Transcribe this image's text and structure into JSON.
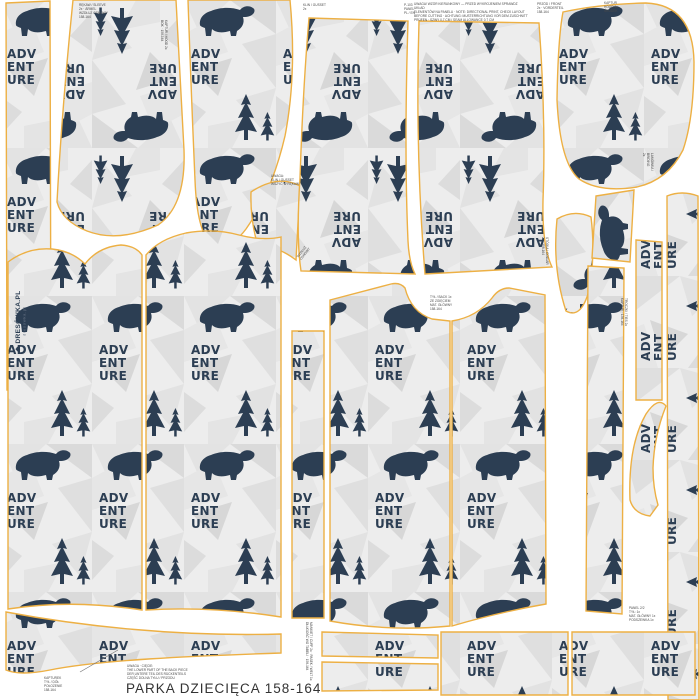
{
  "panel": {
    "title": "PARKA DZIECIĘCA 158-164"
  },
  "brand": {
    "icon": "❖",
    "name": "DRESÓWKA.PL",
    "sub": "dresowka.pl"
  },
  "pattern": {
    "lines": [
      "ADV",
      "ENT",
      "URE"
    ],
    "navy": "#2c3e53",
    "bg": "#ededed",
    "outline": "#edb044",
    "facets": [
      [
        "0,0 46,0 14,30",
        "#e3e3e3"
      ],
      [
        "46,0 92,0 92,34",
        "#dadada"
      ],
      [
        "0,34 30,18 44,52 0,66",
        "#e6e6e6"
      ],
      [
        "92,34 58,44 92,88",
        "#dfdfdf"
      ],
      [
        "8,70 48,58 34,96",
        "#d7d7d7"
      ],
      [
        "52,100 92,88 80,132",
        "#e2e2e2"
      ],
      [
        "0,96 22,112 0,136",
        "#dcdcdc"
      ],
      [
        "24,126 64,118 48,148 24,148",
        "#e4e4e4"
      ]
    ]
  },
  "pieces": [
    {
      "name": "strip-left",
      "orient": "up",
      "d": "M6,3 L50,1 L51,388 L7,390 Z"
    },
    {
      "name": "sleeve-top-left",
      "orient": "down",
      "d": "M73,0 L176,0 L184,150 Q186,206 158,225 Q118,243 87,231 Q62,221 57,202 Q62,108 73,0 Z"
    },
    {
      "name": "hood-side-left",
      "orient": "up",
      "d": "M188,0 L290,0 Q297,74 285,136 Q272,192 246,229 Q228,253 211,243 Q197,232 195,180 Q191,88 188,0 Z"
    },
    {
      "name": "gusset",
      "orient": "down",
      "d": "M251,192 Q278,174 300,186 L296,260 Q272,242 260,252 Q250,224 251,192 Z"
    },
    {
      "name": "sleeve-top-center-left",
      "orient": "down",
      "d": "M309,18 L408,21 Q404,150 408,241 Q409,262 415,274 L301,271 Q296,238 300,178 Q303,88 309,18 Z"
    },
    {
      "name": "sleeve-top-center-right",
      "orient": "down",
      "d": "M419,21 L539,23 Q546,120 543,200 Q542,246 552,267 L425,274 Q415,150 419,21 Z"
    },
    {
      "name": "hood-right",
      "orient": "up",
      "d": "M563,12 Q600,4 646,3 Q693,5 694,62 Q694,118 683,150 Q668,180 637,187 Q600,193 579,179 Q560,163 557,100 Q558,38 563,12 Z"
    },
    {
      "name": "collar-tail",
      "orient": "down",
      "d": "M557,219 Q574,209 591,217 Q596,258 588,294 Q580,319 566,311 Q552,268 557,219 Z"
    },
    {
      "name": "strip-right-top",
      "orient": "side",
      "d": "M596,196 L634,190 L630,262 L592,258 Z"
    },
    {
      "name": "strip-front-edge",
      "orient": "up",
      "d": "M588,266 L624,268 L622,614 L586,611 Z"
    },
    {
      "name": "strip-binding-trees",
      "orient": "side",
      "d": "M636,240 L662,242 L662,400 L636,400 Z"
    },
    {
      "name": "strip-right-edge",
      "orient": "side",
      "d": "M667,196 Q682,190 698,196 L699,700 L668,700 Z"
    },
    {
      "name": "collar-curve",
      "orient": "side",
      "d": "M630,500 Q628,445 646,414 Q658,396 666,406 Q654,436 653,468 Q653,488 658,505 L650,516 Q634,514 630,500 Z"
    },
    {
      "name": "body-left-a",
      "orient": "up",
      "d": "M8,262 Q28,247 52,249 Q72,251 85,264 Q98,247 121,245 Q136,246 142,255 L142,610 Q72,599 8,609 Z"
    },
    {
      "name": "body-left-b",
      "orient": "up",
      "d": "M146,255 Q159,239 186,233 Q214,228 239,235 Q262,241 281,237 L281,617 Q212,606 146,610 Z"
    },
    {
      "name": "hem-band",
      "orient": "up",
      "d": "M6,612 C80,626 180,637 281,634 L281,653 C190,656 100,660 50,670 Q20,676 6,670 Z"
    },
    {
      "name": "strip-center",
      "orient": "up",
      "d": "M292,331 L324,331 L324,618 L292,618 Z"
    },
    {
      "name": "body-center-left",
      "orient": "up",
      "d": "M330,300 L391,284 Q400,282 405,288 Q411,312 432,319 L450,321 L450,626 Q390,632 330,621 Z"
    },
    {
      "name": "body-center-right",
      "orient": "up",
      "d": "M452,321 Q477,317 492,298 Q499,288 509,288 L545,295 L546,604 Q500,612 452,626 Z"
    },
    {
      "name": "cuff-top",
      "orient": "up",
      "d": "M322,632 L438,635 L438,658 L322,656 Z"
    },
    {
      "name": "cuff-bottom",
      "orient": "up",
      "d": "M322,662 L438,664 L438,690 L322,691 Z"
    },
    {
      "name": "pocket-left",
      "orient": "up",
      "d": "M441,632 L568,632 L568,695 L441,695 Z"
    },
    {
      "name": "pocket-right",
      "orient": "up",
      "d": "M572,632 L695,632 L695,695 L572,695 Z"
    }
  ],
  "labels": [
    {
      "name": "sleeve-label",
      "x": 79,
      "y": 3,
      "rot": 0,
      "size": 3.2,
      "lines": [
        "RĘKAW / SLEEVE",
        "2x · ÄRMEL",
        "WZDŁUŻ OSNOWY",
        "158-164"
      ]
    },
    {
      "name": "hood-side-label",
      "x": 168,
      "y": 20,
      "rot": 90,
      "size": 3.2,
      "lines": [
        "KAPTUR / HOOD 2x",
        "BOK · 158-164"
      ]
    },
    {
      "name": "cutting-instructions",
      "x": 414,
      "y": 2,
      "rot": 0,
      "size": 3.2,
      "lines": [
        "UWAGA! WZÓR KIERUNKOWY — PRZED WYKROJENIEM SPRAWDŹ UKŁAD",
        "ELEMENTÓW NA PANELU · NOTE: DIRECTIONAL PRINT, CHECK LAYOUT",
        "BEFORE CUTTING · ACHTUNG: MUSTERRICHTUNG VOR DEM ZUSCHNITT",
        "PRÜFEN · SZWY 0,7 CM / SEAM ALLOWANCE 0.7 CM"
      ]
    },
    {
      "name": "panel-top-note",
      "x": 404,
      "y": 3,
      "rot": 0,
      "size": 3.2,
      "lines": [
        "P-103",
        "PANEL",
        "PL / EN"
      ]
    },
    {
      "name": "gusset-top-note",
      "x": 303,
      "y": 3,
      "rot": 0,
      "size": 3.2,
      "lines": [
        "KLIN / GUSSET",
        "2x"
      ]
    },
    {
      "name": "front-label",
      "x": 537,
      "y": 2,
      "rot": 0,
      "size": 3.2,
      "lines": [
        "PRZÓD / FRONT",
        "2x · VORDERTEIL",
        "158-164"
      ]
    },
    {
      "name": "hood-center-label",
      "x": 604,
      "y": 1,
      "rot": 0,
      "size": 3.2,
      "lines": [
        "KAPTUR",
        "HOOD 1x",
        "ŚRODEK"
      ]
    },
    {
      "name": "gusset-label",
      "x": 271,
      "y": 174,
      "rot": 0,
      "size": 3.2,
      "lines": [
        "UWAGA:",
        "KLIN / GUSSET",
        "WSZYĆ W RĘKAW"
      ]
    },
    {
      "name": "grain-label",
      "x": 296,
      "y": 256,
      "rot": -52,
      "size": 3.2,
      "lines": [
        "WZDŁUŻ",
        "OSNOWY"
      ]
    },
    {
      "name": "back-label",
      "x": 430,
      "y": 295,
      "rot": 0,
      "size": 3.2,
      "lines": [
        "TYŁ / BACK 1x",
        "ZE ZGIĘCIEM",
        "MAT. GŁÓWNY",
        "158-164"
      ]
    },
    {
      "name": "collar-label",
      "x": 549,
      "y": 237,
      "rot": 90,
      "size": 3.2,
      "lines": [
        "STÓJKA / COLLAR",
        "2x · 158-164"
      ]
    },
    {
      "name": "drawstring-label",
      "x": 628,
      "y": 298,
      "rot": 90,
      "size": 3.2,
      "lines": [
        "TROCZKI / TIES 2x",
        "KAPTUR · 158-164"
      ]
    },
    {
      "name": "binding-label",
      "x": 654,
      "y": 153,
      "rot": 90,
      "size": 3.2,
      "lines": [
        "LAMÓWKA / BINDING",
        "2x"
      ]
    },
    {
      "name": "cuff-note",
      "x": 313,
      "y": 622,
      "rot": 90,
      "size": 3.2,
      "lines": [
        "MANKIET / CUFF 2x · PASEK / WELT 1x",
        "DŁUGOŚĆ WG TABELI · 158-164"
      ]
    },
    {
      "name": "panel-note",
      "x": 629,
      "y": 606,
      "rot": 0,
      "size": 3.2,
      "lines": [
        "PANEL 2/2",
        "TYŁ: 1x",
        "MAT. GŁÓWNY 1x",
        "PODSZEWKA 1x"
      ]
    },
    {
      "name": "hood-back-label",
      "x": 44,
      "y": 676,
      "rot": 0,
      "size": 3.2,
      "lines": [
        "KAPTUREK",
        "TYŁ / DÓŁ",
        "POŁOŻENIE",
        "158-164"
      ]
    },
    {
      "name": "bottom-note",
      "x": 127,
      "y": 664,
      "rot": 0,
      "size": 3.2,
      "lines": [
        "UWAGA · CIĘCIE:",
        "THE LOWER PART OF THE BACK PIECE",
        "DER UNTERE TEIL DES RÜCKENTEILS",
        "CZĘŚĆ DOLNA TYŁU / PRZODU"
      ]
    }
  ],
  "arrow": {
    "x1": 80,
    "y1": 672,
    "x2": 118,
    "y2": 650
  }
}
